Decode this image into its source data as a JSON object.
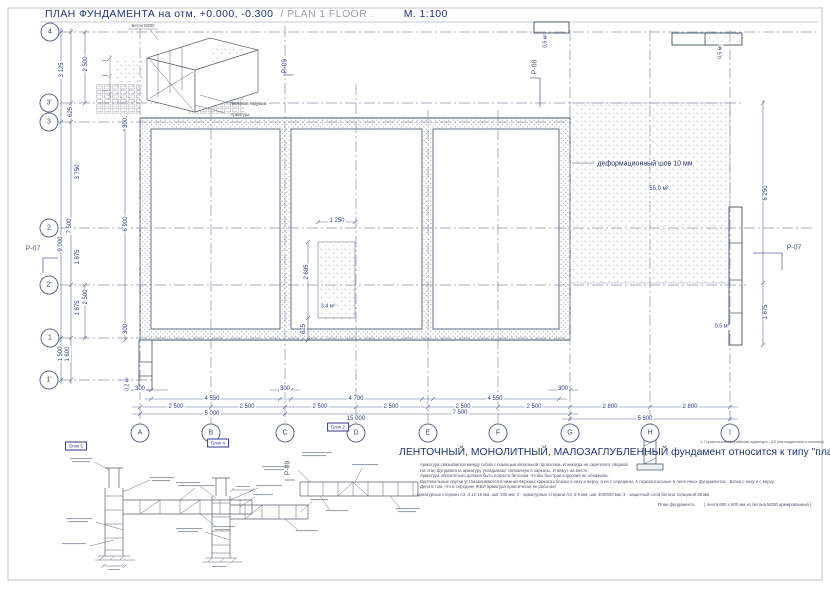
{
  "title": {
    "main": "ПЛАН ФУНДАМЕНТА на отм. +0.000, -0.300",
    "secondary": "/ PLAN 1 FLOOR .",
    "scale": "М. 1:100"
  },
  "heading": "ЛЕНТОЧНЫЙ, МОНОЛИТНЫЙ, МАЛОЗАГЛУБЛЕННЫЙ фундамент относится к типу \"плавающая плита \"",
  "axes": {
    "left": [
      "4",
      "3'",
      "3",
      "2",
      "2'",
      "1",
      "1'"
    ],
    "bottom": [
      "A",
      "B",
      "C",
      "D",
      "E",
      "F",
      "G",
      "H",
      "I"
    ]
  },
  "dims": {
    "wall300": [
      "300",
      "300",
      "300"
    ],
    "spans": [
      "4 550",
      "4 700",
      "4 550"
    ],
    "grid_steps": [
      "2 500",
      "2 500",
      "2 500",
      "2 500",
      "2 500",
      "2 500",
      "2 800",
      "2 800"
    ],
    "totals": [
      "5 000",
      "15 000",
      "7 500",
      "5 600"
    ],
    "left": [
      "2 500",
      "3 125",
      "625",
      "3 750",
      "7 500",
      "9 000",
      "1 875",
      "2 500",
      "1 875",
      "1 500",
      "1 600"
    ],
    "plan_left": [
      "300",
      "6 900",
      "300"
    ],
    "pit": [
      "1 250",
      "2 685",
      "625"
    ],
    "right": [
      "6 250",
      "1 875"
    ]
  },
  "areas": {
    "slab": "55,0 м²",
    "pit": "3,4 м²",
    "block_top_left": "0,5 м²",
    "block_top_right": "0,5 м²",
    "block_right": "0,5 м²",
    "block_bottom_left": "0,2 м²"
  },
  "sections": {
    "p07_left": "Р-07",
    "p07_right": "Р-07",
    "p08": "Р-08",
    "p09_top": "Р-09",
    "p09_detail": "Р-09"
  },
  "callouts": {
    "deform_joint": "деформационный шов 10 мм",
    "block5": "Блок 5",
    "block4": "Блок 4",
    "block2": "Блок 2",
    "iso_concrete": "Бетон М200",
    "iso_sand": "Песчаная подушка",
    "iso_rebar": "Арматура"
  },
  "notes": {
    "legend": "1. Горизонтальная рабочая арматура - А3 (периодического сечения)",
    "lines": [
      "Арматура связывается между собой с помощью вязальной проволоки. И никогда не скрепляют сваркой.",
      "На этап фундамента арматуру укладывают связанную в каркасы. И вяжут на месте.",
      "Арматура обязательно должна быть покрыта бетоном. Чтобы быстрая коррозия не обнажила.",
      "Вертикальные прутки устанавливаются в нижних-верхних каркасах близко к низу и верху, а не с середины. А горизонтальные в ленточных фундаментах - Вязка с низу и с верху.",
      "Дело в том, что в середине ЖБИ арматура практически не работает",
      "- арматурные стержни А3, d 12-16 мм, шаг 200 мм; 2 - арматурные стержни А3, d 8 мм, шаг 400/600 мм; 3 - защитный слой бетона толщиной 35 мм"
    ],
    "footer_label": "План фундамента",
    "footer_spec": "( лента 600 х 600 мм из бетона М200 армированный )"
  },
  "colors": {
    "line_main": "#3d4f66",
    "line_dim": "#5b6b9e",
    "text_blue": "#2b3a8c",
    "title_navy": "#1f3472",
    "grid": "#8a93a6"
  }
}
